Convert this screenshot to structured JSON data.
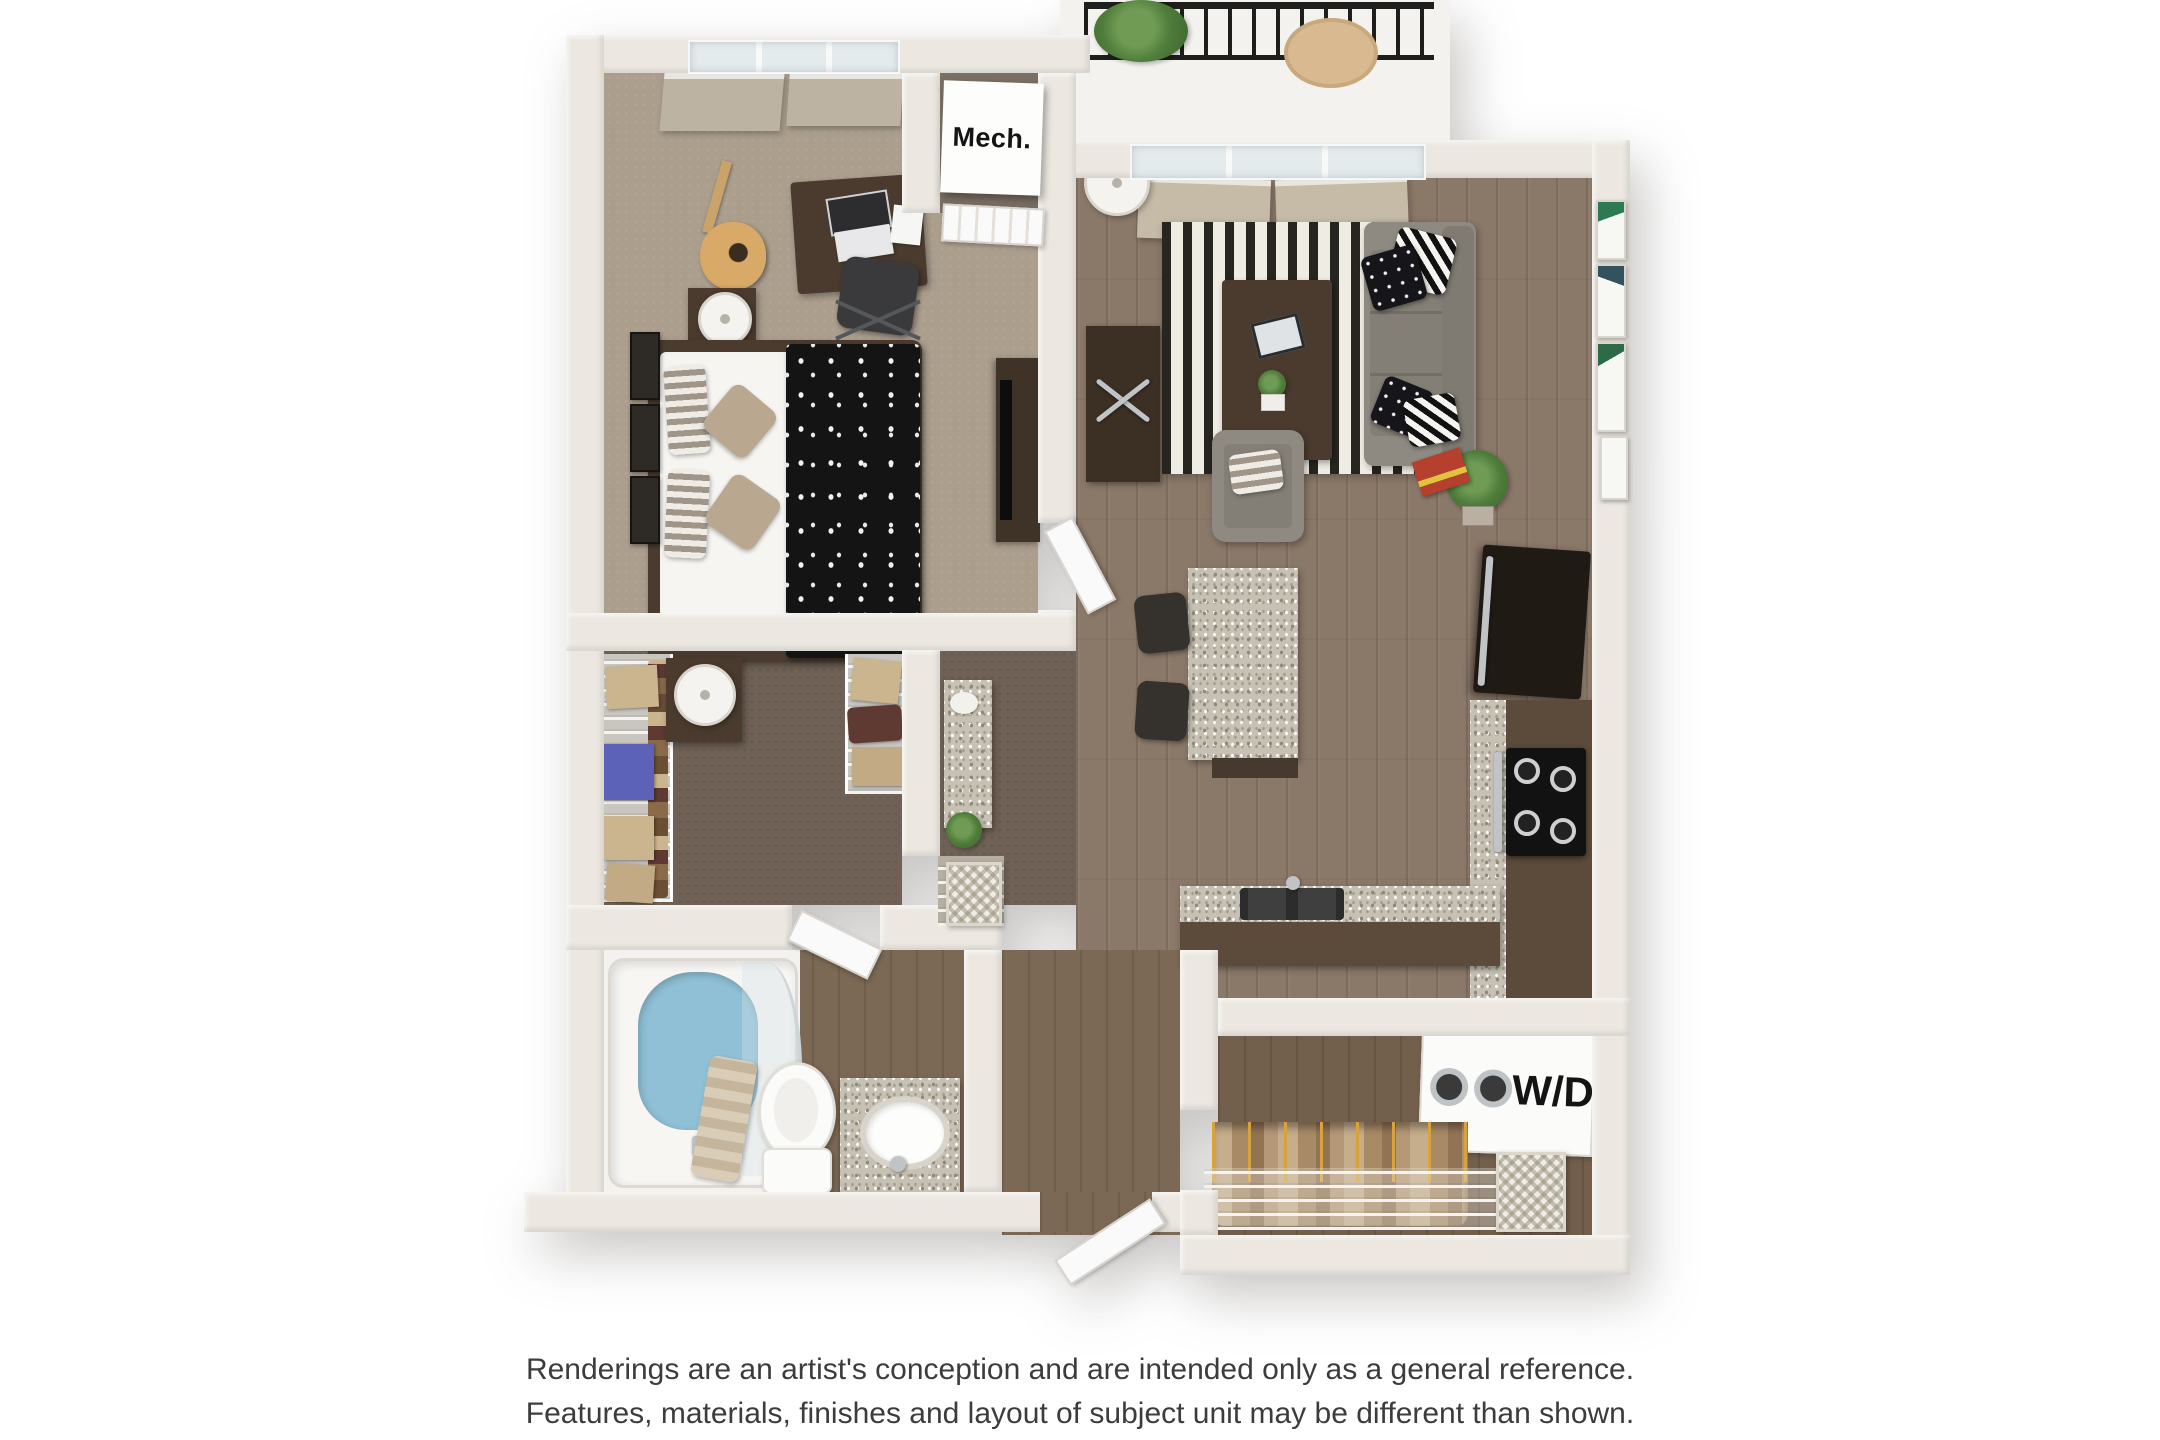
{
  "labels": {
    "mechanical_closet": "Mech.",
    "washer_dryer": "W/D"
  },
  "disclaimer": {
    "line1": "Renderings are an artist's conception and are intended only as a general reference.",
    "line2": "Features, materials, finishes and layout of subject unit may be different than shown."
  },
  "floorplan": {
    "description": "3D top-down rendering of a one-bedroom, one-bathroom apartment floor plan",
    "rooms": [
      "balcony",
      "living room",
      "kitchen",
      "bedroom",
      "walk-in closet",
      "bathroom",
      "mechanical closet",
      "entry",
      "laundry / storage closet"
    ],
    "colors": {
      "background": "#ffffff",
      "wall": "#ece8e1",
      "wood_floor": "#8a7868",
      "wood_floor_dark": "#73604c",
      "bedroom_carpet": "#ab9e8d",
      "closet_carpet": "#6f6155",
      "granite_counter": "#c7c1b4",
      "cabinetry_brown": "#5c4a3a",
      "sofa_gray": "#8f8a81",
      "rug_stripe_dark": "#26251f",
      "rug_stripe_light": "#efece4",
      "bedding_black": "#141414",
      "bath_water_blue": "#8fc0d6",
      "balcony_railing": "#1e1e1c",
      "plant_green": "#4e7c3a",
      "accent_red_book": "#b5402e"
    }
  }
}
